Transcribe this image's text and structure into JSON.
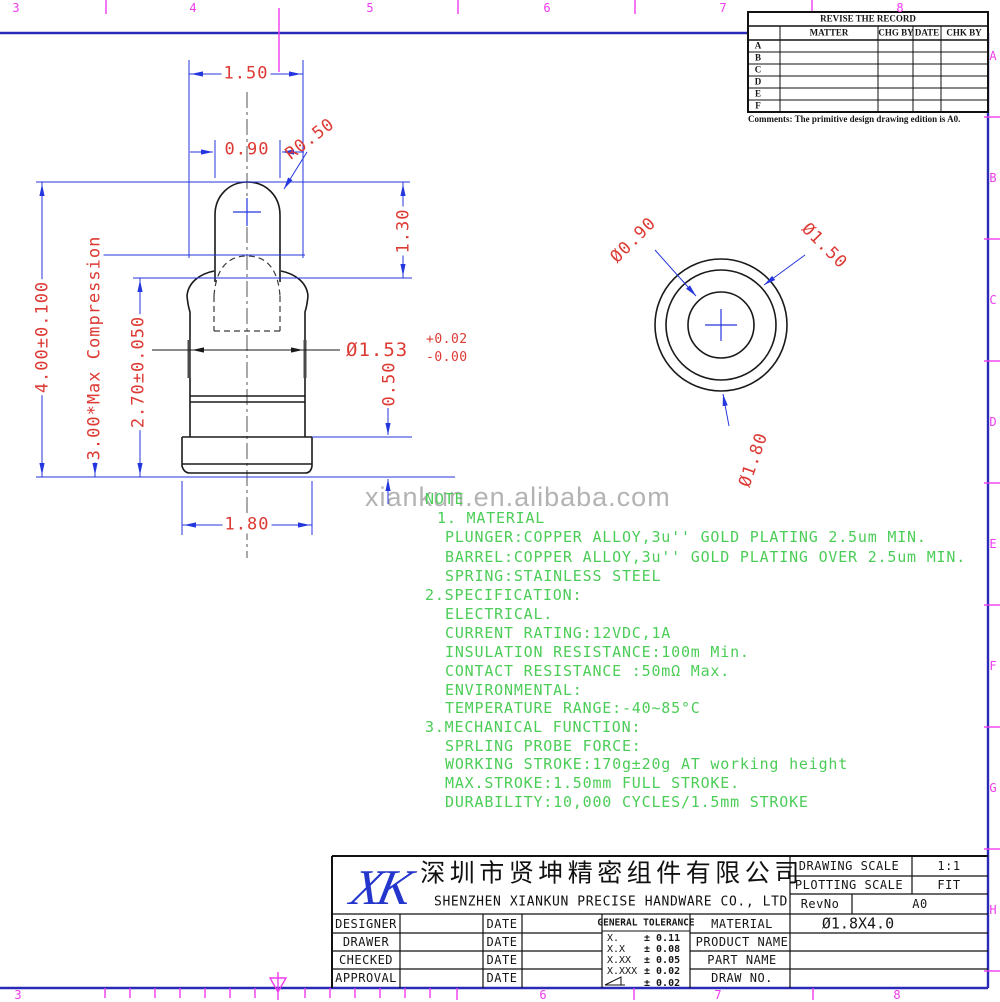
{
  "sheet": {
    "zone_numbers_top": [
      "3",
      "4",
      "5",
      "6",
      "7",
      "8"
    ],
    "zone_numbers_bottom": [
      "3",
      "6",
      "7",
      "8"
    ],
    "zone_letters_right": [
      "A",
      "B",
      "C",
      "D",
      "E",
      "F",
      "G",
      "H"
    ]
  },
  "watermark": "xiankun.en.alibaba.com",
  "revision_table": {
    "title": "REVISE THE RECORD",
    "col_matter": "MATTER",
    "col_chg": "CHG BY",
    "col_date": "DATE",
    "col_chk": "CHK BY",
    "rows": [
      "A",
      "B",
      "C",
      "D",
      "E",
      "F"
    ],
    "comments": "Comments: The primitive design drawing edition is A0."
  },
  "front_view": {
    "dim_top_width": "1.50",
    "dim_plunger_width": "0.90",
    "dim_tip_radius": "R0.50",
    "dim_exposed_height": "1.30",
    "dim_total_height": "4.00±0.100",
    "dim_compressed": "3.00*Max Compression",
    "dim_barrel_height": "2.70±0.050",
    "dim_barrel_dia": "Ø1.53",
    "dim_barrel_dia_tol_plus": "+0.02",
    "dim_barrel_dia_tol_minus": "-0.00",
    "dim_flange_height": "0.50",
    "dim_flange_width": "1.80"
  },
  "top_view": {
    "dim_inner": "Ø0.90",
    "dim_mid": "Ø1.50",
    "dim_outer": "Ø1.80"
  },
  "notes": {
    "lines": [
      {
        "text": "NOTE"
      },
      {
        "text": "1. MATERIAL"
      },
      {
        "text": "PLUNGER:COPPER ALLOY,3u'' GOLD PLATING 2.5um MIN."
      },
      {
        "text": "BARREL:COPPER ALLOY,3u'' GOLD PLATING OVER 2.5um MIN."
      },
      {
        "text": "SPRING:STAINLESS STEEL"
      },
      {
        "text": "2.SPECIFICATION:"
      },
      {
        "text": "ELECTRICAL."
      },
      {
        "text": "CURRENT RATING:12VDC,1A"
      },
      {
        "text": "INSULATION RESISTANCE:100m Min."
      },
      {
        "text": "CONTACT RESISTANCE :50mΩ Max."
      },
      {
        "text": "ENVIRONMENTAL:"
      },
      {
        "text": "TEMPERATURE RANGE:-40~85°C"
      },
      {
        "text": "3.MECHANICAL FUNCTION:"
      },
      {
        "text": "SPRLING PROBE FORCE:"
      },
      {
        "text": "WORKING STROKE:170g±20g AT working height"
      },
      {
        "text": "MAX.STROKE:1.50mm FULL STROKE."
      },
      {
        "text": "DURABILITY:10,000 CYCLES/1.5mm STROKE"
      }
    ]
  },
  "title_block": {
    "logo_text": "XK",
    "company_cn": "深圳市贤坤精密组件有限公司",
    "company_en": "SHENZHEN XIANKUN PRECISE HANDWARE CO., LTD",
    "drawing_scale_label": "DRAWING SCALE",
    "drawing_scale_value": "1:1",
    "plotting_scale_label": "PLOTTING SCALE",
    "plotting_scale_value": "FIT",
    "revno_label": "RevNo",
    "revno_value": "A0",
    "row_designer": "DESIGNER",
    "row_drawer": "DRAWER",
    "row_checked": "CHECKED",
    "row_approval": "APPROVAL",
    "date_label": "DATE",
    "tol_header": "GENERAL TOLERANCE",
    "tol_rows": [
      {
        "k": "X.",
        "v": "± 0.11"
      },
      {
        "k": "X.X",
        "v": "± 0.08"
      },
      {
        "k": "X.XX",
        "v": "± 0.05"
      },
      {
        "k": "X.XXX",
        "v": "± 0.02"
      },
      {
        "k": "",
        "v": "± 0.02"
      }
    ],
    "field_material": "MATERIAL",
    "field_product": "PRODUCT NAME",
    "field_part": "PART NAME",
    "field_draw": "DRAW NO.",
    "material_value": "Ø1.8X4.0"
  }
}
